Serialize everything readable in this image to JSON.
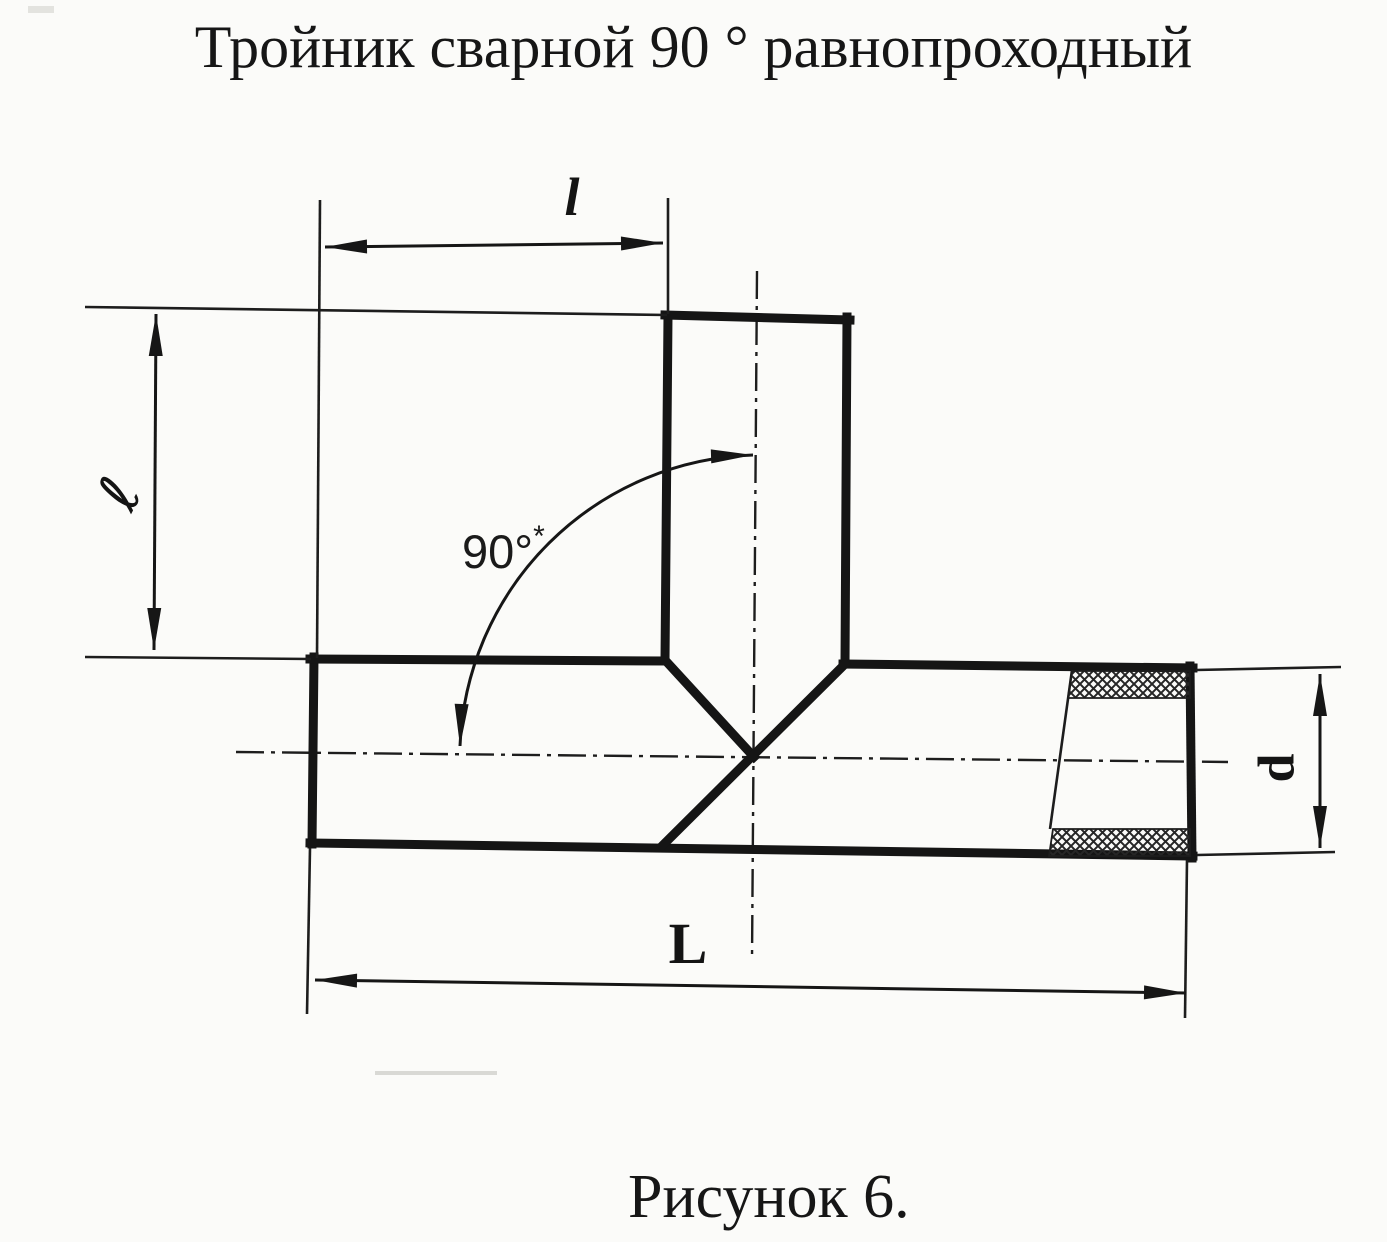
{
  "page": {
    "background": "#fbfbf9",
    "ink": "#161616"
  },
  "title": "Тройник сварной 90 ° равнопроходный",
  "caption": "Рисунок 6.",
  "dimensions": {
    "branch_length_top": "l",
    "branch_length_left": "ℓ",
    "angle": "90°",
    "angle_note": "*",
    "overall_length": "L",
    "diameter": "d"
  }
}
